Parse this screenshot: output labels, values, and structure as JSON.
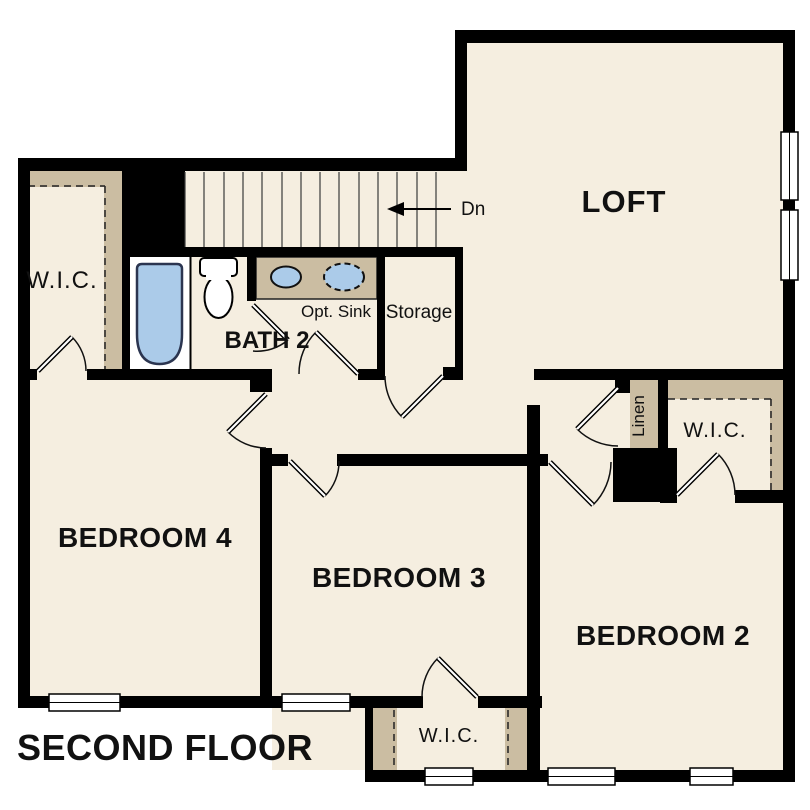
{
  "title": "SECOND FLOOR",
  "colors": {
    "wall": "#000000",
    "floor": "#f5eee0",
    "closet_shading": "#cbbda2",
    "fixture_blue": "#abcbe9",
    "line": "#111111",
    "background": "#ffffff"
  },
  "rooms": {
    "loft": {
      "label": "LOFT"
    },
    "bedroom4": {
      "label": "BEDROOM 4"
    },
    "bedroom3": {
      "label": "BEDROOM 3"
    },
    "bedroom2": {
      "label": "BEDROOM 2"
    },
    "bath2": {
      "label": "BATH 2"
    },
    "storage": {
      "label": "Storage"
    },
    "linen": {
      "label": "Linen"
    },
    "wic_bedroom4": {
      "label": "W.I.C."
    },
    "wic_bedroom2": {
      "label": "W.I.C."
    },
    "wic_bedroom3": {
      "label": "W.I.C."
    },
    "opt_sink": {
      "label": "Opt. Sink"
    },
    "stairs": {
      "label": "Dn"
    }
  }
}
